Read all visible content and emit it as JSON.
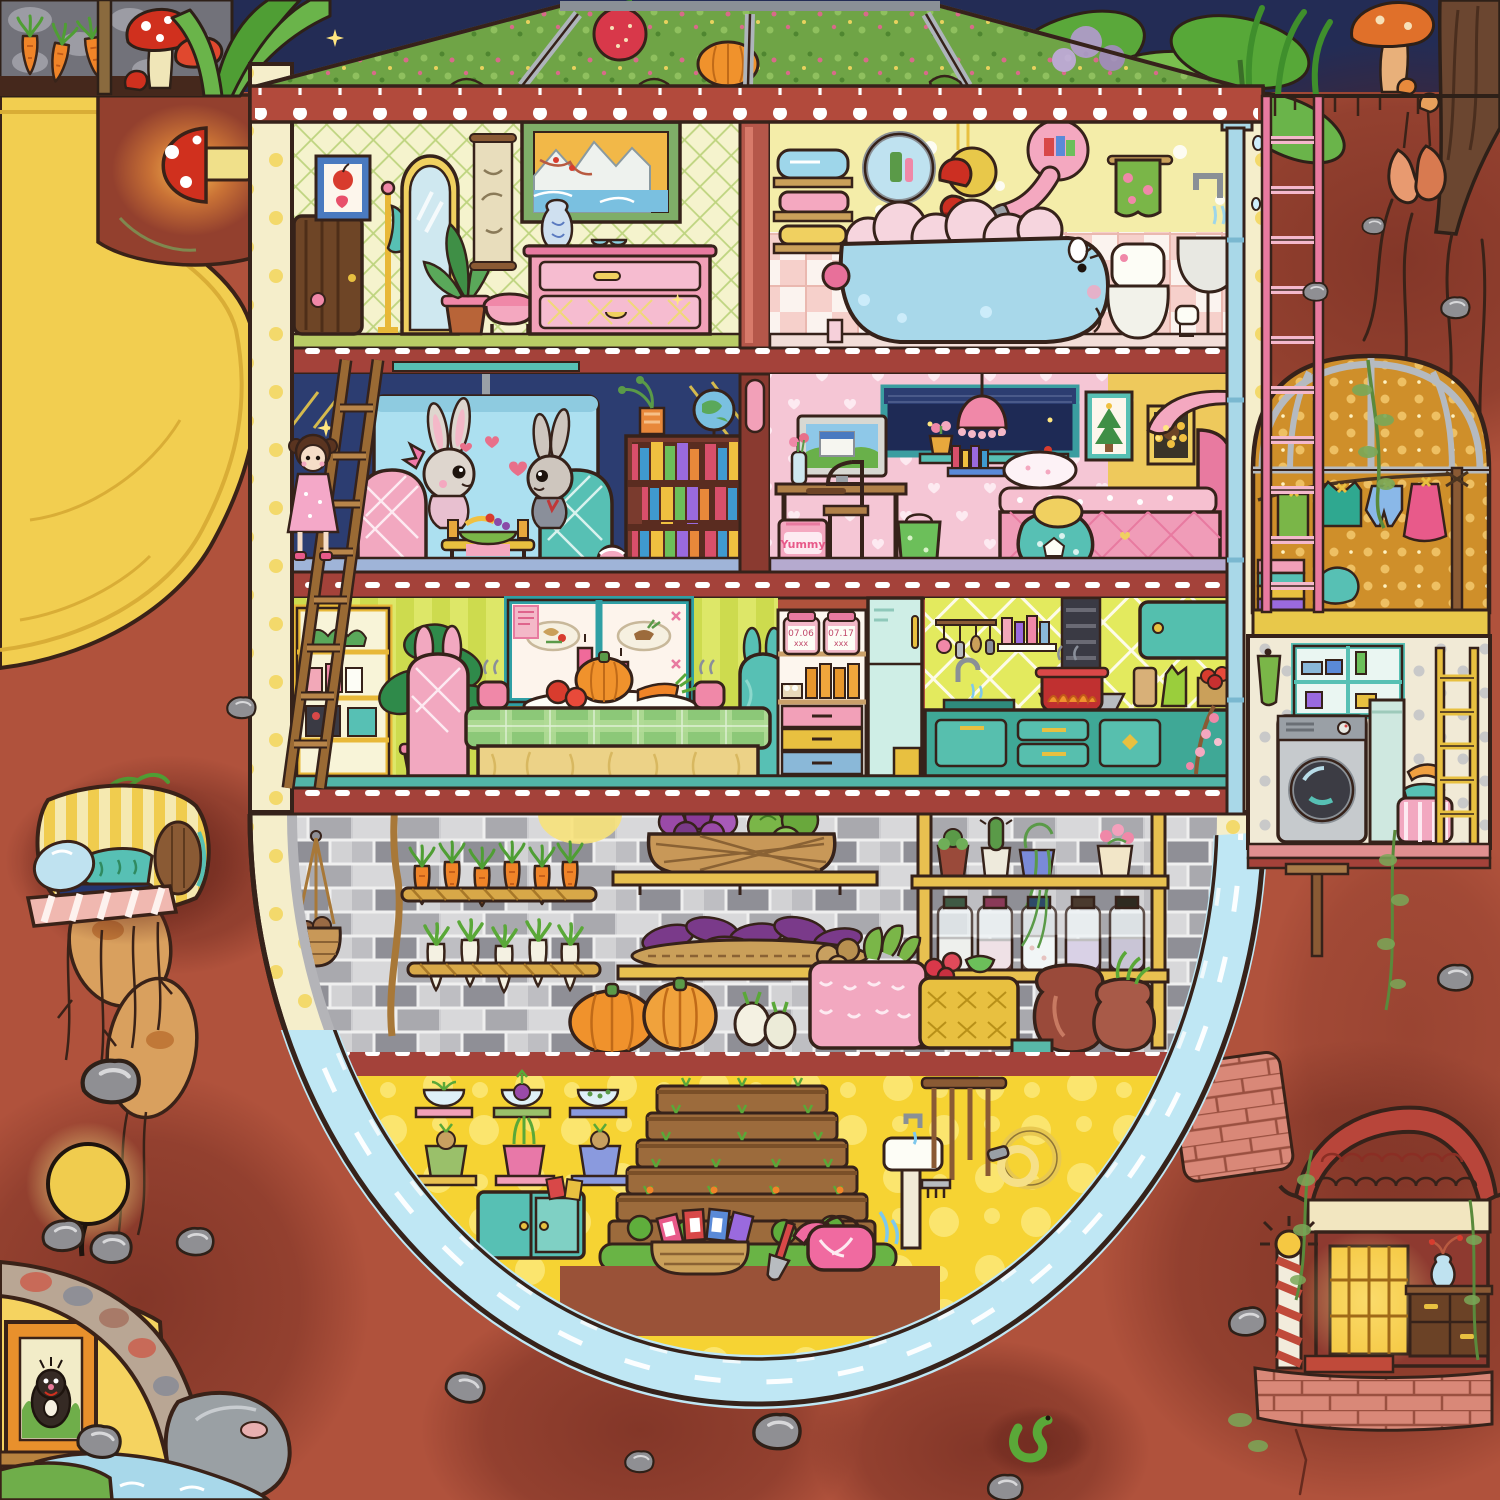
{
  "scene": {
    "kind": "cutaway-illustration",
    "setting": "Underground rabbit burrow house beneath a greenhouse meadow, cross-section view",
    "style": "hand-drawn children picture book, terracotta earth with stones, roots and side dens"
  },
  "palette": {
    "earth": "#b0523c",
    "earth_dark": "#7c3226",
    "house_wall": "#f5eecb",
    "slab_red": "#a4423a",
    "roof_glass_green": "#6fa446",
    "water": "#bfe7f4",
    "grow_yellow": "#f6d333",
    "living_navy": "#2c3d71",
    "bedroom_pink": "#f5c6d5",
    "dining_lime": "#dde768",
    "kitchen_teal": "#3fa896",
    "tub_blue": "#a8d8ea",
    "dome_gold": "#cf8f2a",
    "tunnel_yellow": "#f2ce50"
  },
  "regions": {
    "above_ground": {
      "objects": [
        "carrot planter in stone box",
        "red spotted mushrooms",
        "corn leaves",
        "strawberry",
        "big taro leaves with dew",
        "orange mushrooms",
        "tree trunk with roots",
        "night sky sparkles"
      ]
    },
    "greenhouse_roof": {
      "objects": [
        "slanted glass panels",
        "meadow with flowers seen through glass",
        "moss clumps",
        "red eave with white scallops"
      ]
    },
    "floor1_dressing_room": {
      "objects": [
        "wooden door",
        "apple picture",
        "coat stand",
        "arched mirror",
        "potted plant",
        "pink stool",
        "hanging scroll",
        "mountain lake painting",
        "blue vase",
        "pink dresser",
        "sunglasses"
      ]
    },
    "floor1_bathroom": {
      "objects": [
        "towel shelves",
        "bunny ear mirror",
        "red bell lamps",
        "pink rabbit shower",
        "flower towel",
        "rabbit shaped bathtub full of pink foam",
        "toilet",
        "wall sink",
        "toilet paper",
        "rain drainpipe"
      ]
    },
    "floor2_living_room": {
      "objects": [
        "projector and screen",
        "two rabbits sharing fruit",
        "pink plaid chair",
        "teal plaid chair",
        "fruit table",
        "bookshelf",
        "globe",
        "beach ball",
        "wooden ladder",
        "little doll girl",
        "gold sparkles"
      ]
    },
    "floor2_bedroom": {
      "snack_box_label": "Yummy",
      "objects": [
        "desk with computer",
        "wooden chair",
        "flower vase",
        "night window",
        "pink fringe lamp",
        "wall shelf with books",
        "christmas tree picture",
        "sunflower picture",
        "pink heart bed",
        "arched reading lamp",
        "polka bean bag with lemon cushion",
        "green gift bag"
      ]
    },
    "floor3_dining_room": {
      "objects": [
        "striped wallpaper",
        "pass-through window with two plates",
        "two pink candles",
        "plaid table with pumpkin, tomatoes and carrots",
        "steaming cups",
        "bunny-ear chairs",
        "yellow cabinet with terrarium and jams",
        "big monstera plant",
        "hanging rope"
      ]
    },
    "floor3_pantry": {
      "jar_labels": [
        {
          "date": "07.06",
          "note": "xxx"
        },
        {
          "date": "07.17",
          "note": "xxx"
        }
      ],
      "objects": [
        "preserve jars with date labels",
        "juice bottles",
        "egg tray",
        "three color drawers",
        "mint fridge",
        "yellow bin"
      ]
    },
    "floor3_kitchen": {
      "objects": [
        "lime tile backsplash",
        "bottle shelf",
        "range hood duct",
        "hanging utensils",
        "red pot on painted fire",
        "cutting board",
        "green bag",
        "tomato box",
        "teal wall cabinet",
        "teal base cabinets",
        "cherry blossom branch"
      ]
    },
    "cellar": {
      "objects": [
        "gray brick wall",
        "hanging onion basket",
        "rope",
        "carrot rack",
        "daikon rack",
        "basket of red onions and cabbages",
        "tray of purple sweet potatoes",
        "plant pot shelf",
        "pickle jars",
        "pumpkins",
        "turnips",
        "pink potato basket",
        "strawberry basket",
        "two clay jugs",
        "drain pipe"
      ]
    },
    "grow_room": {
      "objects": [
        "sprout bowls on shelves",
        "seedling pots",
        "teal cabinet",
        "terraced seed pyramid",
        "seed packet basket",
        "shovel",
        "pink watering can",
        "white sink",
        "tool rack",
        "coiled yellow hose",
        "water channel ring"
      ]
    },
    "right_annex": {
      "drying_dome": {
        "objects": [
          "golden glass dome",
          "clothesline with shirt, shorts and dress",
          "folded towels",
          "wooden pole",
          "pink ladders"
        ]
      },
      "laundry_room": {
        "objects": [
          "polka wallpaper",
          "supply cabinet",
          "green towel",
          "washing machine",
          "mint locker",
          "laundry basket",
          "orange towel",
          "yellow ladder"
        ]
      },
      "shrine_room": {
        "objects": [
          "curved red tile roof",
          "glowing golden doorway",
          "striped post",
          "small lamp",
          "wooden chest",
          "blue vase with branch",
          "red mat",
          "vines"
        ]
      }
    },
    "left_annex": {
      "yellow_tunnel": {
        "objects": [
          "curved yellow burrow",
          "glowing mushroom lamp",
          "vine"
        ]
      },
      "sleeping_nook": {
        "objects": [
          "striped pod bed",
          "round wooden door",
          "blue pillow",
          "teal blanket",
          "striped brick ledge",
          "hanging roots"
        ]
      },
      "mole_den": {
        "objects": [
          "globe lamp on rock",
          "cobblestone arch",
          "framed mole portrait",
          "wooden ledge",
          "gray boulder",
          "blue stream",
          "green mound"
        ]
      }
    },
    "earth_details": {
      "objects": [
        "gray stones",
        "cracks",
        "roots",
        "pink brick patches",
        "sprouting tuber",
        "green worm",
        "hanging twin root"
      ]
    }
  }
}
